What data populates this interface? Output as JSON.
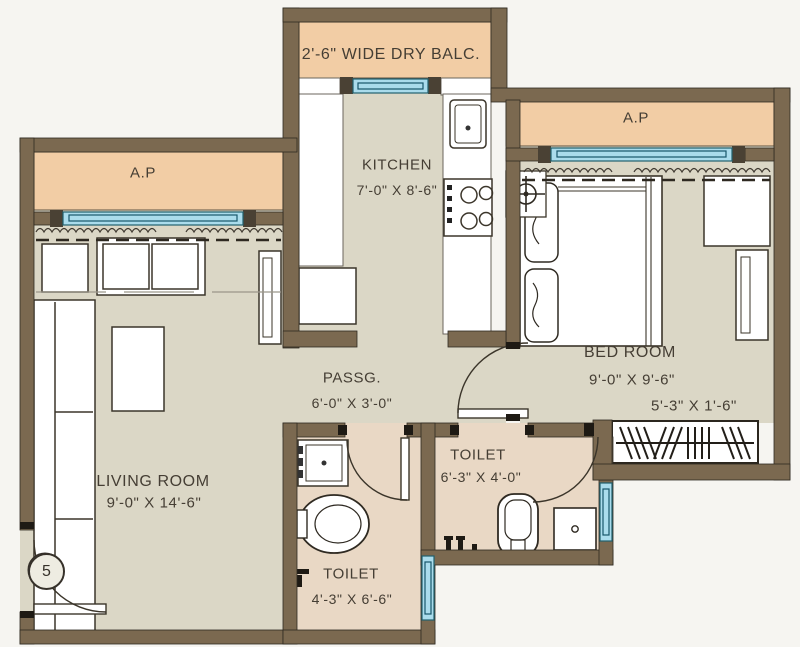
{
  "unit": {
    "number": "5"
  },
  "rooms": {
    "dry_balcony": {
      "name": "2'-6\" WIDE DRY BALC."
    },
    "ap_left": {
      "name": "A.P"
    },
    "ap_right": {
      "name": "A.P"
    },
    "kitchen": {
      "name": "KITCHEN",
      "dims": "7'-0\" X 8'-6\""
    },
    "bedroom": {
      "name": "BED ROOM",
      "dims": "9'-0\" X 9'-6\""
    },
    "wardrobe": {
      "dims": "5'-3\" X 1'-6\""
    },
    "passage": {
      "name": "PASSG.",
      "dims": "6'-0\" X 3'-0\""
    },
    "toilet_right": {
      "name": "TOILET",
      "dims": "6'-3\" X 4'-0\""
    },
    "toilet_left": {
      "name": "TOILET",
      "dims": "4'-3\" X 6'-6\""
    },
    "living_room": {
      "name": "LIVING ROOM",
      "dims": "9'-0\" X 14'-6\""
    }
  },
  "colors": {
    "wall": "#7b6950",
    "floor": "#dbd7c6",
    "toilet_floor": "#e9d8c5",
    "balcony_fill": "#f2cda5",
    "window": "#aadcec",
    "line": "#2f2a21"
  }
}
